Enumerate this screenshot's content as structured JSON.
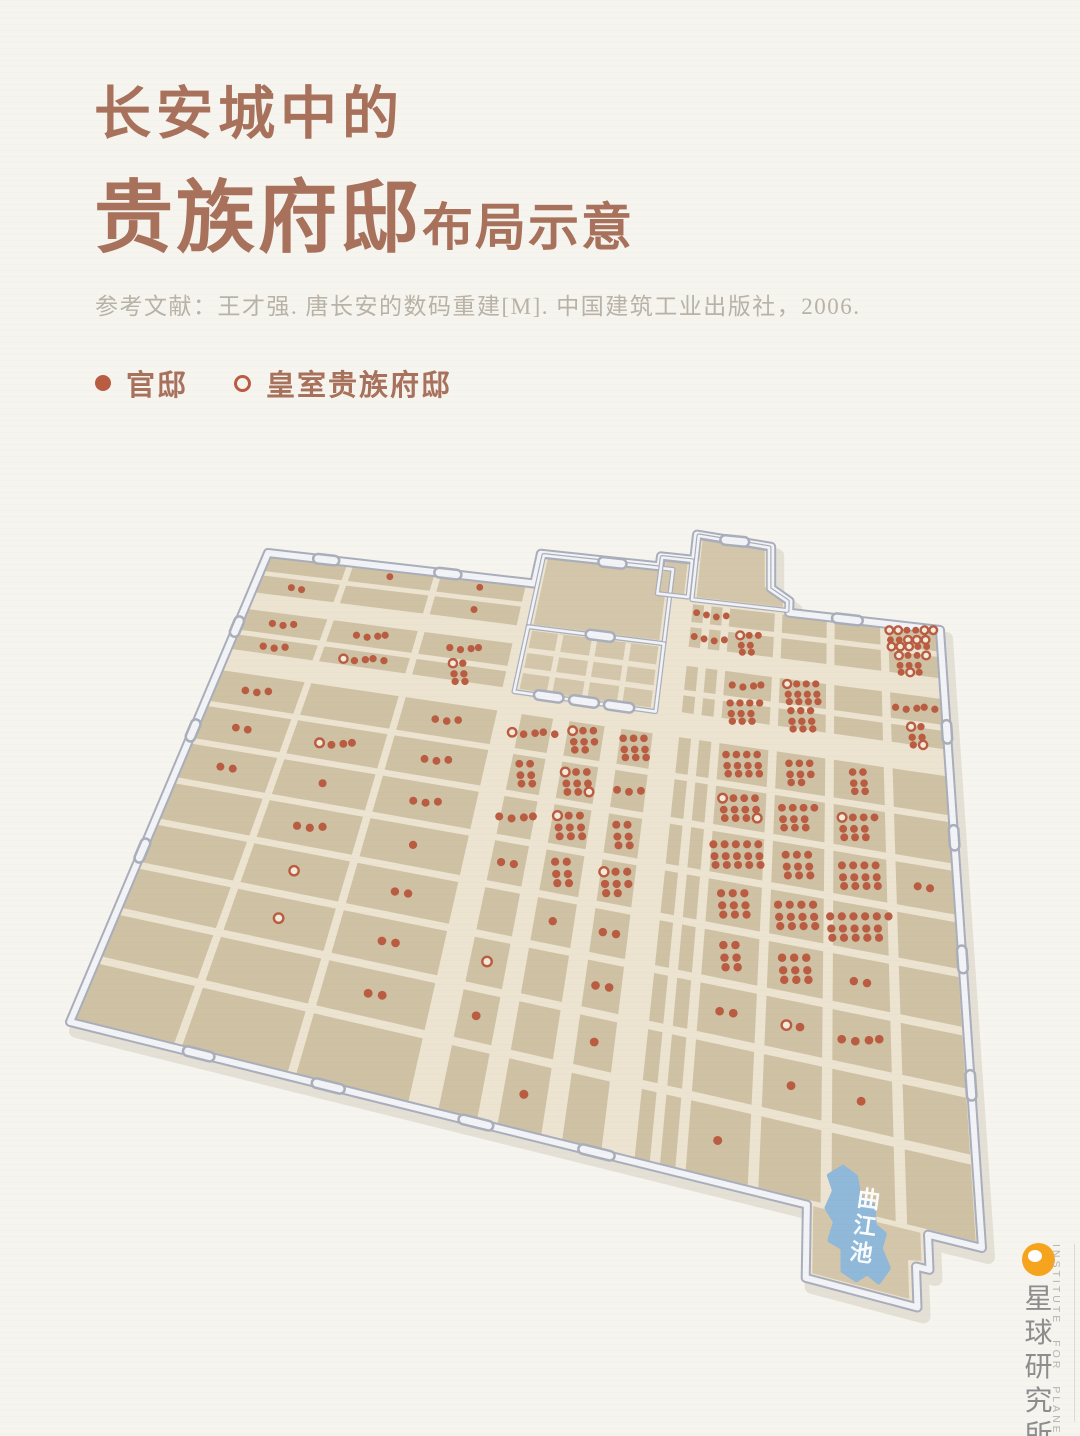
{
  "header": {
    "title_line1": "长安城中的",
    "title_line2_big": "贵族府邸",
    "title_line2_small": "布局示意",
    "reference": "参考文献：王才强. 唐长安的数码重建[M]. 中国建筑工业出版社，2006."
  },
  "legend": {
    "items": [
      {
        "label": "官邸",
        "marker": "filled-dot"
      },
      {
        "label": "皇室贵族府邸",
        "marker": "hollow-dot"
      }
    ]
  },
  "brand": {
    "logo": "planet-icon",
    "name_cn": "星球研究所",
    "name_en": "INSTITUTE FOR PLANETS"
  },
  "colors": {
    "background": "#f6f4ee",
    "title": "#a8715c",
    "reference_text": "#b8b2a7",
    "legend_text": "#a8715c",
    "dot": "#ba5c42",
    "dot_hollow_fill": "#f3ebda",
    "block": "#cfc1a4",
    "block_palace": "#d3c6aa",
    "street": "#ece4d1",
    "wall_edge": "#a9aeba",
    "wall_face": "#f2f3f7",
    "wall_shadow": "#ded9cc",
    "lake": "#8fb8d9",
    "lake_text": "#ffffff",
    "logo_orange": "#f6a41d",
    "brand_cn_text": "#8d8d8d",
    "brand_en_text": "#b6b4b0"
  },
  "map": {
    "label_lake": "曲江池",
    "corners": {
      "nw": [
        268,
        553
      ],
      "ne": [
        940,
        630
      ],
      "se": [
        982,
        1248
      ],
      "sw": [
        70,
        1022
      ]
    },
    "outline": [
      [
        0,
        0
      ],
      [
        0.435,
        0
      ],
      [
        0.435,
        -0.08
      ],
      [
        0.615,
        -0.08
      ],
      [
        0.615,
        -0.107
      ],
      [
        0.664,
        -0.107
      ],
      [
        0.664,
        -0.175
      ],
      [
        0.773,
        -0.162
      ],
      [
        0.776,
        -0.055
      ],
      [
        0.802,
        -0.028
      ],
      [
        0.802,
        0
      ],
      [
        1,
        0
      ],
      [
        1,
        1
      ],
      [
        0.952,
        1
      ],
      [
        0.952,
        1.04
      ],
      [
        0.94,
        1.04
      ],
      [
        0.94,
        1.085
      ],
      [
        0.84,
        1.085
      ],
      [
        0.84,
        1
      ],
      [
        0,
        1
      ]
    ],
    "rows": [
      [
        0,
        0.056
      ],
      [
        0.056,
        0.115
      ],
      [
        0.147,
        0.213
      ],
      [
        0.213,
        0.262
      ],
      [
        0.302,
        0.387
      ],
      [
        0.387,
        0.472
      ],
      [
        0.472,
        0.557
      ],
      [
        0.557,
        0.642
      ],
      [
        0.642,
        0.727
      ],
      [
        0.727,
        0.812
      ],
      [
        0.812,
        0.897
      ],
      [
        0.897,
        1.0
      ]
    ],
    "sections": {
      "w": {
        "cols": [
          [
            0,
            0.142
          ],
          [
            0.142,
            0.285
          ],
          [
            0.285,
            0.428
          ]
        ],
        "row_start": 0
      },
      "m": {
        "cols": [
          [
            0.452,
            0.506
          ],
          [
            0.518,
            0.576
          ],
          [
            0.588,
            0.64
          ]
        ],
        "row_start": 4
      },
      "e": {
        "cols": [
          [
            0.664,
            0.69
          ],
          [
            0.69,
            0.716
          ],
          [
            0.716,
            0.788
          ],
          [
            0.788,
            0.858
          ],
          [
            0.858,
            0.928
          ],
          [
            0.928,
            1.0
          ]
        ],
        "row_start": 0
      }
    },
    "solid_fills": {
      "palace": [
        [
          0.447,
          -0.068
        ],
        [
          0.628,
          -0.068
        ],
        [
          0.628,
          0.102
        ],
        [
          0.447,
          0.102
        ]
      ],
      "imperial": [
        [
          0.447,
          0.117
        ],
        [
          0.628,
          0.117
        ],
        [
          0.628,
          0.255
        ],
        [
          0.447,
          0.255
        ]
      ],
      "step": [
        [
          0.623,
          -0.096
        ],
        [
          0.655,
          -0.096
        ],
        [
          0.655,
          -0.016
        ],
        [
          0.623,
          -0.016
        ]
      ],
      "daming": [
        [
          0.673,
          -0.164
        ],
        [
          0.764,
          -0.152
        ],
        [
          0.767,
          -0.057
        ],
        [
          0.793,
          -0.032
        ],
        [
          0.793,
          -0.012
        ],
        [
          0.673,
          -0.012
        ]
      ],
      "jut": [
        [
          0.846,
          1.0
        ],
        [
          0.945,
          1.0
        ],
        [
          0.945,
          1.032
        ],
        [
          0.933,
          1.035
        ],
        [
          0.933,
          1.078
        ],
        [
          0.846,
          1.078
        ]
      ]
    },
    "inner_walls": {
      "palace": [
        [
          0.44,
          -0.076
        ],
        [
          0.635,
          -0.076
        ],
        [
          0.635,
          0.109
        ],
        [
          0.44,
          0.109
        ]
      ],
      "imperial": [
        [
          0.44,
          0.109
        ],
        [
          0.635,
          0.109
        ],
        [
          0.635,
          0.262
        ],
        [
          0.44,
          0.262
        ]
      ],
      "step": [
        [
          0.617,
          -0.104
        ],
        [
          0.661,
          -0.104
        ],
        [
          0.661,
          -0.01
        ],
        [
          0.617,
          -0.01
        ]
      ],
      "daming": [
        [
          0.667,
          -0.172
        ],
        [
          0.77,
          -0.159
        ],
        [
          0.773,
          -0.053
        ],
        [
          0.799,
          -0.027
        ],
        [
          0.799,
          -0.005
        ],
        [
          0.667,
          -0.005
        ]
      ]
    },
    "inner_streets": [
      [
        0.489,
        0.118,
        0.489,
        0.258
      ],
      [
        0.538,
        0.118,
        0.538,
        0.258
      ],
      [
        0.586,
        0.118,
        0.586,
        0.258
      ],
      [
        0.443,
        0.165,
        0.632,
        0.165
      ],
      [
        0.443,
        0.212,
        0.632,
        0.212
      ]
    ],
    "gates": [
      {
        "o": "h",
        "u": 0.1,
        "v": 0
      },
      {
        "o": "h",
        "u": 0.3,
        "v": 0
      },
      {
        "o": "h",
        "u": 0.88,
        "v": 0
      },
      {
        "o": "h",
        "u": 0.545,
        "v": -0.076
      },
      {
        "o": "h",
        "u": 0.72,
        "v": -0.168
      },
      {
        "o": "h",
        "u": 0.489,
        "v": 0.262
      },
      {
        "o": "h",
        "u": 0.538,
        "v": 0.262
      },
      {
        "o": "h",
        "u": 0.586,
        "v": 0.262
      },
      {
        "o": "h",
        "u": 0.545,
        "v": 0.109
      },
      {
        "o": "v",
        "u": 0,
        "v": 0.2
      },
      {
        "o": "v",
        "u": 0,
        "v": 0.45
      },
      {
        "o": "v",
        "u": 0,
        "v": 0.7
      },
      {
        "o": "h",
        "u": 0.17,
        "v": 1
      },
      {
        "o": "h",
        "u": 0.33,
        "v": 1
      },
      {
        "o": "h",
        "u": 0.5,
        "v": 1
      },
      {
        "o": "h",
        "u": 0.63,
        "v": 1
      },
      {
        "o": "v",
        "u": 1,
        "v": 0.22
      },
      {
        "o": "v",
        "u": 1,
        "v": 0.42
      },
      {
        "o": "v",
        "u": 1,
        "v": 0.62
      },
      {
        "o": "v",
        "u": 1,
        "v": 0.8
      }
    ],
    "lake_shape": [
      [
        0.874,
        0.944
      ],
      [
        0.886,
        0.952
      ],
      [
        0.889,
        0.975
      ],
      [
        0.902,
        0.982
      ],
      [
        0.903,
        1.005
      ],
      [
        0.912,
        1.012
      ],
      [
        0.908,
        1.03
      ],
      [
        0.915,
        1.05
      ],
      [
        0.906,
        1.068
      ],
      [
        0.896,
        1.061
      ],
      [
        0.886,
        1.072
      ],
      [
        0.874,
        1.066
      ],
      [
        0.874,
        1.04
      ],
      [
        0.862,
        1.035
      ],
      [
        0.867,
        1.012
      ],
      [
        0.859,
        0.998
      ],
      [
        0.866,
        0.975
      ],
      [
        0.861,
        0.958
      ]
    ],
    "lake_label_anchor": [
      0.897,
      0.985
    ],
    "dot_style": {
      "r": 4.0,
      "dx": 12,
      "dy": 10.5
    },
    "dot_clusters": [
      [
        "w",
        1,
        0,
        1,
        0
      ],
      [
        "w",
        2,
        0,
        1,
        0
      ],
      [
        "w",
        0,
        1,
        2,
        0
      ],
      [
        "w",
        2,
        1,
        1,
        0
      ],
      [
        "w",
        0,
        2,
        3,
        0
      ],
      [
        "w",
        1,
        2,
        4,
        0
      ],
      [
        "w",
        2,
        2,
        4,
        0
      ],
      [
        "w",
        0,
        3,
        3,
        0
      ],
      [
        "w",
        1,
        3,
        5,
        1
      ],
      [
        "w",
        2,
        3,
        6,
        1
      ],
      [
        "w",
        0,
        4,
        3,
        0
      ],
      [
        "w",
        2,
        4,
        3,
        0
      ],
      [
        "w",
        0,
        5,
        2,
        0
      ],
      [
        "w",
        1,
        5,
        4,
        1
      ],
      [
        "w",
        2,
        5,
        3,
        0
      ],
      [
        "w",
        0,
        6,
        2,
        0
      ],
      [
        "w",
        1,
        6,
        1,
        0
      ],
      [
        "w",
        2,
        6,
        3,
        0
      ],
      [
        "w",
        1,
        7,
        3,
        0
      ],
      [
        "w",
        2,
        7,
        1,
        0
      ],
      [
        "w",
        1,
        8,
        1,
        1
      ],
      [
        "w",
        2,
        8,
        2,
        0
      ],
      [
        "w",
        1,
        9,
        1,
        1
      ],
      [
        "w",
        2,
        9,
        2,
        0
      ],
      [
        "w",
        2,
        10,
        2,
        0
      ],
      [
        "m",
        0,
        4,
        5,
        1
      ],
      [
        "m",
        1,
        4,
        8,
        1
      ],
      [
        "m",
        2,
        4,
        9,
        0
      ],
      [
        "m",
        0,
        5,
        6,
        0
      ],
      [
        "m",
        1,
        5,
        9,
        2
      ],
      [
        "m",
        2,
        5,
        3,
        0
      ],
      [
        "m",
        0,
        6,
        4,
        0
      ],
      [
        "m",
        1,
        6,
        9,
        1
      ],
      [
        "m",
        2,
        6,
        6,
        0
      ],
      [
        "m",
        0,
        7,
        2,
        0
      ],
      [
        "m",
        1,
        7,
        6,
        0
      ],
      [
        "m",
        2,
        7,
        8,
        1
      ],
      [
        "m",
        1,
        8,
        1,
        0
      ],
      [
        "m",
        2,
        8,
        2,
        0
      ],
      [
        "m",
        0,
        9,
        1,
        1
      ],
      [
        "m",
        2,
        9,
        2,
        0
      ],
      [
        "m",
        0,
        10,
        1,
        0
      ],
      [
        "m",
        2,
        10,
        1,
        0
      ],
      [
        "m",
        1,
        11,
        1,
        0
      ],
      [
        "e",
        0,
        0,
        1,
        0
      ],
      [
        "e",
        1,
        0,
        3,
        0
      ],
      [
        "e",
        5,
        0,
        16,
        10
      ],
      [
        "e",
        0,
        1,
        1,
        0
      ],
      [
        "e",
        1,
        1,
        3,
        0
      ],
      [
        "e",
        2,
        1,
        7,
        1
      ],
      [
        "e",
        5,
        1,
        10,
        3
      ],
      [
        "e",
        2,
        2,
        4,
        0
      ],
      [
        "e",
        3,
        2,
        12,
        1
      ],
      [
        "e",
        5,
        2,
        5,
        0
      ],
      [
        "e",
        2,
        3,
        10,
        0
      ],
      [
        "e",
        3,
        3,
        9,
        0
      ],
      [
        "e",
        5,
        3,
        6,
        2
      ],
      [
        "e",
        2,
        4,
        12,
        0
      ],
      [
        "e",
        3,
        4,
        8,
        0
      ],
      [
        "e",
        4,
        4,
        6,
        0
      ],
      [
        "e",
        2,
        5,
        12,
        2
      ],
      [
        "e",
        3,
        5,
        10,
        0
      ],
      [
        "e",
        4,
        5,
        10,
        1
      ],
      [
        "e",
        2,
        6,
        15,
        0
      ],
      [
        "e",
        3,
        6,
        9,
        0
      ],
      [
        "e",
        4,
        6,
        12,
        0
      ],
      [
        "e",
        5,
        6,
        2,
        0
      ],
      [
        "e",
        2,
        7,
        9,
        0
      ],
      [
        "e",
        3,
        7,
        12,
        0
      ],
      [
        "e",
        4,
        7,
        16,
        0
      ],
      [
        "e",
        2,
        8,
        6,
        0
      ],
      [
        "e",
        3,
        8,
        9,
        0
      ],
      [
        "e",
        4,
        8,
        2,
        0
      ],
      [
        "e",
        2,
        9,
        2,
        0
      ],
      [
        "e",
        3,
        9,
        2,
        1
      ],
      [
        "e",
        4,
        9,
        4,
        0
      ],
      [
        "e",
        3,
        10,
        1,
        0
      ],
      [
        "e",
        4,
        10,
        1,
        0
      ],
      [
        "e",
        2,
        11,
        1,
        0
      ]
    ]
  }
}
